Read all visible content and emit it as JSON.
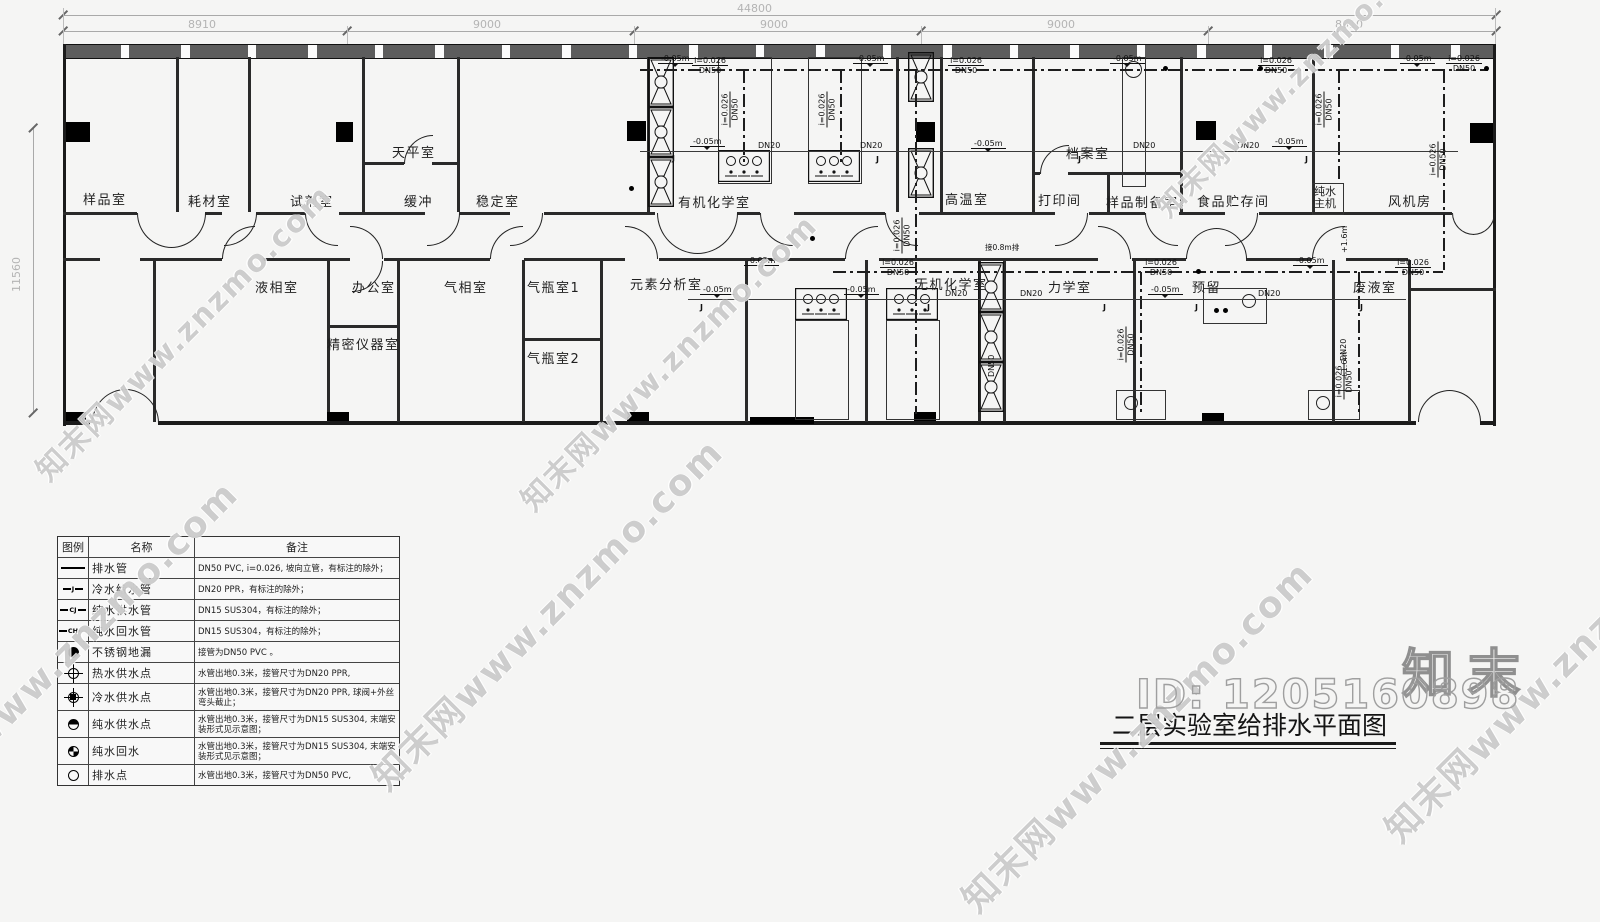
{
  "colors": {
    "line": "#1b1b1b",
    "dim_text": "#b4b4b4",
    "watermark": "#878787"
  },
  "dimensions": {
    "total": "44800",
    "segments": [
      "8910",
      "9000",
      "9000",
      "9000",
      "8910"
    ],
    "left_height": "11560"
  },
  "rooms": {
    "sample": "样品室",
    "consumables": "耗材室",
    "reagent": "试剂室",
    "balance": "天平室",
    "buffer": "缓冲",
    "stability": "稳定室",
    "organic_chem": "有机化学室",
    "high_temp": "高温室",
    "archive": "档案室",
    "print_room": "打印间",
    "sample_prep": "样品制备室",
    "food_storage": "食品贮存间",
    "pure_water_host": "纯水主机",
    "fan_room": "风机房",
    "liquid_phase": "液相室",
    "office": "办公室",
    "precision_instrument": "精密仪器室",
    "gas_phase": "气相室",
    "gas_cylinder_1": "气瓶室1",
    "gas_cylinder_2": "气瓶室2",
    "elemental_analysis": "元素分析室",
    "inorganic_chem": "无机化学室",
    "mechanics": "力学室",
    "reserved": "预留",
    "waste_liquid": "废液室"
  },
  "pipe_labels": {
    "dn50": "DN50",
    "dn20": "DN20",
    "slope": "i=0.026",
    "elev_neg": "-0.05m",
    "elev_pos": "+1.6m",
    "j": "J",
    "connect": "接0.8m排"
  },
  "legend": {
    "headers": [
      "图例",
      "名称",
      "备注"
    ],
    "rows": [
      {
        "name": "排水管",
        "note": "DN50 PVC, i=0.026, 坡向立管，有标注的除外；",
        "sym": ""
      },
      {
        "name": "冷水给水管",
        "note": "DN20 PPR，有标注的除外；",
        "sym": "J"
      },
      {
        "name": "纯水供水管",
        "note": "DN15 SUS304，有标注的除外；",
        "sym": "CJ"
      },
      {
        "name": "纯水回水管",
        "note": "DN15 SUS304，有标注的除外；",
        "sym": "CH"
      },
      {
        "name": "不锈钢地漏",
        "note": "接管为DN50 PVC 。",
        "sym": ""
      },
      {
        "name": "热水供水点",
        "note": "水管出地0.3米，接管尺寸为DN20 PPR,",
        "sym": ""
      },
      {
        "name": "冷水供水点",
        "note": "水管出地0.3米，接管尺寸为DN20 PPR, 球阀+外丝弯头截止；",
        "sym": ""
      },
      {
        "name": "纯水供水点",
        "note": "水管出地0.3米，接管尺寸为DN15 SUS304, 末端安装形式见示意图；",
        "sym": ""
      },
      {
        "name": "纯水回水",
        "note": "水管出地0.3米，接管尺寸为DN15 SUS304, 末端安装形式见示意图；",
        "sym": ""
      },
      {
        "name": "排水点",
        "note": "水管出地0.3米，接管尺寸为DN50 PVC,",
        "sym": ""
      }
    ]
  },
  "title_block": {
    "title": "二层实验室给排水平面图"
  },
  "watermark": {
    "id_text": "ID: 1205160898",
    "logo_text": "知末",
    "tile_text": "知末网www.znzmo.com"
  }
}
